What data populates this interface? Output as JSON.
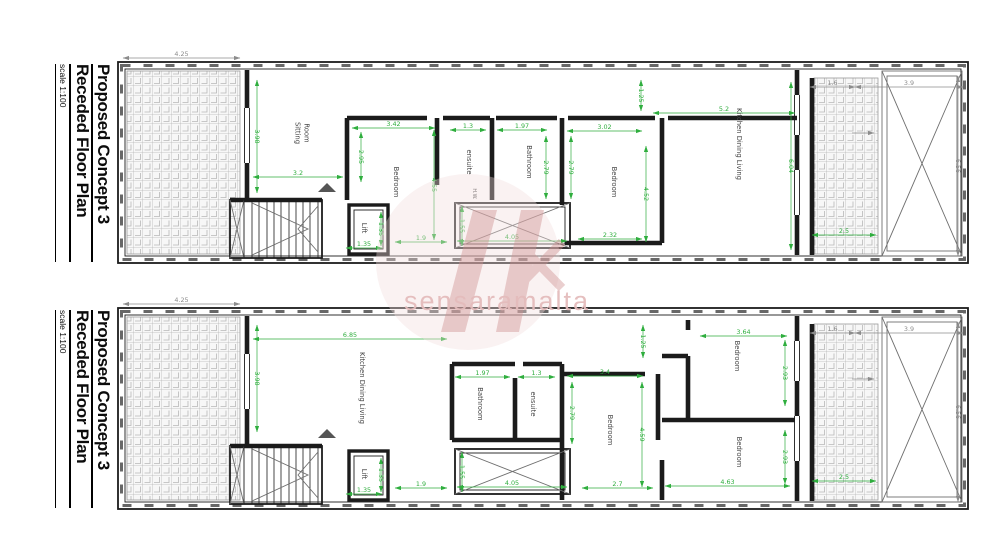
{
  "colors": {
    "dimension_green": "#2fae3e",
    "dimension_gray": "#8c8c8c",
    "wall_black": "#1b1b1b",
    "watermark_text_pink": "#e4bcbc",
    "watermark_logo_pink": "#cf8f8f"
  },
  "watermark": {
    "text": "sensaramalta"
  },
  "plans": [
    {
      "name": "upper-floor-plan",
      "title": {
        "line1": "Proposed Concept 3",
        "line2": "Receded Floor Plan",
        "scale": "scale 1:100"
      },
      "rooms": [
        {
          "label": "Sitting Room",
          "lines": [
            "Sitting",
            "Room"
          ],
          "x": 300,
          "y": 133
        },
        {
          "label": "Bedroom",
          "x": 394,
          "y": 182
        },
        {
          "label": "ensuite",
          "x": 467,
          "y": 162
        },
        {
          "label": "H.W.",
          "x": 473,
          "y": 194,
          "size": 5
        },
        {
          "label": "Bathroom",
          "x": 527,
          "y": 162
        },
        {
          "label": "Bedroom",
          "x": 612,
          "y": 182
        },
        {
          "label": "Kitchen Dining Living",
          "x": 737,
          "y": 144
        },
        {
          "label": "Lift",
          "x": 362,
          "y": 228
        }
      ],
      "dims": [
        {
          "v": "4.25",
          "d": "h",
          "x": 123,
          "y": 58,
          "l": 117,
          "c": "k"
        },
        {
          "v": "3.98",
          "d": "v",
          "x": 257,
          "y": 80,
          "l": 113
        },
        {
          "v": "3.2",
          "d": "h",
          "x": 253,
          "y": 177,
          "l": 90
        },
        {
          "v": "3.42",
          "d": "h",
          "x": 352,
          "y": 128,
          "l": 83
        },
        {
          "v": "2.95",
          "d": "v",
          "x": 361,
          "y": 132,
          "l": 50
        },
        {
          "v": "4.55",
          "d": "v",
          "x": 434,
          "y": 130,
          "l": 110
        },
        {
          "v": "1.3",
          "d": "h",
          "x": 450,
          "y": 130,
          "l": 36
        },
        {
          "v": "1.97",
          "d": "h",
          "x": 497,
          "y": 130,
          "l": 50
        },
        {
          "v": "2.79",
          "d": "v",
          "x": 546,
          "y": 136,
          "l": 63
        },
        {
          "v": "2.79",
          "d": "v",
          "x": 571,
          "y": 136,
          "l": 63
        },
        {
          "v": "3.02",
          "d": "h",
          "x": 567,
          "y": 131,
          "l": 75
        },
        {
          "v": "4.52",
          "d": "v",
          "x": 646,
          "y": 146,
          "l": 96
        },
        {
          "v": "2.32",
          "d": "h",
          "x": 578,
          "y": 239,
          "l": 64
        },
        {
          "v": "5.2",
          "d": "h",
          "x": 653,
          "y": 113,
          "l": 142
        },
        {
          "v": "1.25",
          "d": "v",
          "x": 641,
          "y": 80,
          "l": 31
        },
        {
          "v": "6.04",
          "d": "v",
          "x": 791,
          "y": 82,
          "l": 168
        },
        {
          "v": "1.9",
          "d": "h",
          "x": 395,
          "y": 242,
          "l": 52
        },
        {
          "v": "4.05",
          "d": "h",
          "x": 457,
          "y": 241,
          "l": 110
        },
        {
          "v": "1.55",
          "d": "v",
          "x": 462,
          "y": 206,
          "l": 40
        },
        {
          "v": "2.5",
          "d": "h",
          "x": 812,
          "y": 235,
          "l": 64
        },
        {
          "v": "1.35",
          "d": "h",
          "x": 346,
          "y": 248,
          "l": 36
        },
        {
          "v": "1.35",
          "d": "v",
          "x": 381,
          "y": 212,
          "l": 34
        },
        {
          "v": "1.6",
          "d": "h",
          "x": 810,
          "y": 87,
          "l": 45,
          "c": "k"
        },
        {
          "v": "3.9",
          "d": "h",
          "x": 855,
          "y": 87,
          "l": 108,
          "c": "k"
        },
        {
          "v": "6.56",
          "d": "v",
          "x": 958,
          "y": 76,
          "l": 180,
          "c": "k"
        }
      ]
    },
    {
      "name": "lower-floor-plan",
      "title": {
        "line1": "Proposed Concept 3",
        "line2": "Receded Floor Plan",
        "scale": "scale 1:100"
      },
      "rooms": [
        {
          "label": "Kitchen Dining Living",
          "x": 360,
          "y": 388
        },
        {
          "label": "Bathroom",
          "x": 478,
          "y": 404
        },
        {
          "label": "ensuite",
          "x": 531,
          "y": 404
        },
        {
          "label": "Bedroom",
          "x": 608,
          "y": 430
        },
        {
          "label": "Bedroom",
          "x": 735,
          "y": 356
        },
        {
          "label": "Bedroom",
          "x": 737,
          "y": 452
        },
        {
          "label": "Lift",
          "x": 362,
          "y": 474
        }
      ],
      "dims": [
        {
          "v": "4.25",
          "d": "h",
          "x": 123,
          "y": 304,
          "l": 117,
          "c": "k"
        },
        {
          "v": "6.85",
          "d": "h",
          "x": 253,
          "y": 339,
          "l": 194
        },
        {
          "v": "3.98",
          "d": "v",
          "x": 257,
          "y": 325,
          "l": 107
        },
        {
          "v": "1.97",
          "d": "h",
          "x": 455,
          "y": 377,
          "l": 55
        },
        {
          "v": "1.3",
          "d": "h",
          "x": 518,
          "y": 377,
          "l": 37
        },
        {
          "v": "2.79",
          "d": "v",
          "x": 572,
          "y": 382,
          "l": 62
        },
        {
          "v": "3.4",
          "d": "h",
          "x": 567,
          "y": 376,
          "l": 76
        },
        {
          "v": "4.59",
          "d": "v",
          "x": 642,
          "y": 382,
          "l": 105
        },
        {
          "v": "1.25",
          "d": "v",
          "x": 643,
          "y": 325,
          "l": 33
        },
        {
          "v": "2.7",
          "d": "h",
          "x": 582,
          "y": 488,
          "l": 71
        },
        {
          "v": "3.64",
          "d": "h",
          "x": 700,
          "y": 336,
          "l": 87
        },
        {
          "v": "2.93",
          "d": "v",
          "x": 785,
          "y": 340,
          "l": 66
        },
        {
          "v": "2.93",
          "d": "v",
          "x": 785,
          "y": 430,
          "l": 54
        },
        {
          "v": "4.63",
          "d": "h",
          "x": 665,
          "y": 486,
          "l": 125
        },
        {
          "v": "1.9",
          "d": "h",
          "x": 395,
          "y": 488,
          "l": 52
        },
        {
          "v": "4.05",
          "d": "h",
          "x": 457,
          "y": 487,
          "l": 110
        },
        {
          "v": "1.55",
          "d": "v",
          "x": 462,
          "y": 452,
          "l": 40
        },
        {
          "v": "2.5",
          "d": "h",
          "x": 812,
          "y": 481,
          "l": 64
        },
        {
          "v": "1.35",
          "d": "h",
          "x": 346,
          "y": 494,
          "l": 36
        },
        {
          "v": "1.35",
          "d": "v",
          "x": 381,
          "y": 458,
          "l": 34
        },
        {
          "v": "1.6",
          "d": "h",
          "x": 810,
          "y": 333,
          "l": 45,
          "c": "k"
        },
        {
          "v": "3.9",
          "d": "h",
          "x": 855,
          "y": 333,
          "l": 108,
          "c": "k"
        },
        {
          "v": "6.56",
          "d": "v",
          "x": 958,
          "y": 322,
          "l": 180,
          "c": "k"
        }
      ]
    }
  ]
}
